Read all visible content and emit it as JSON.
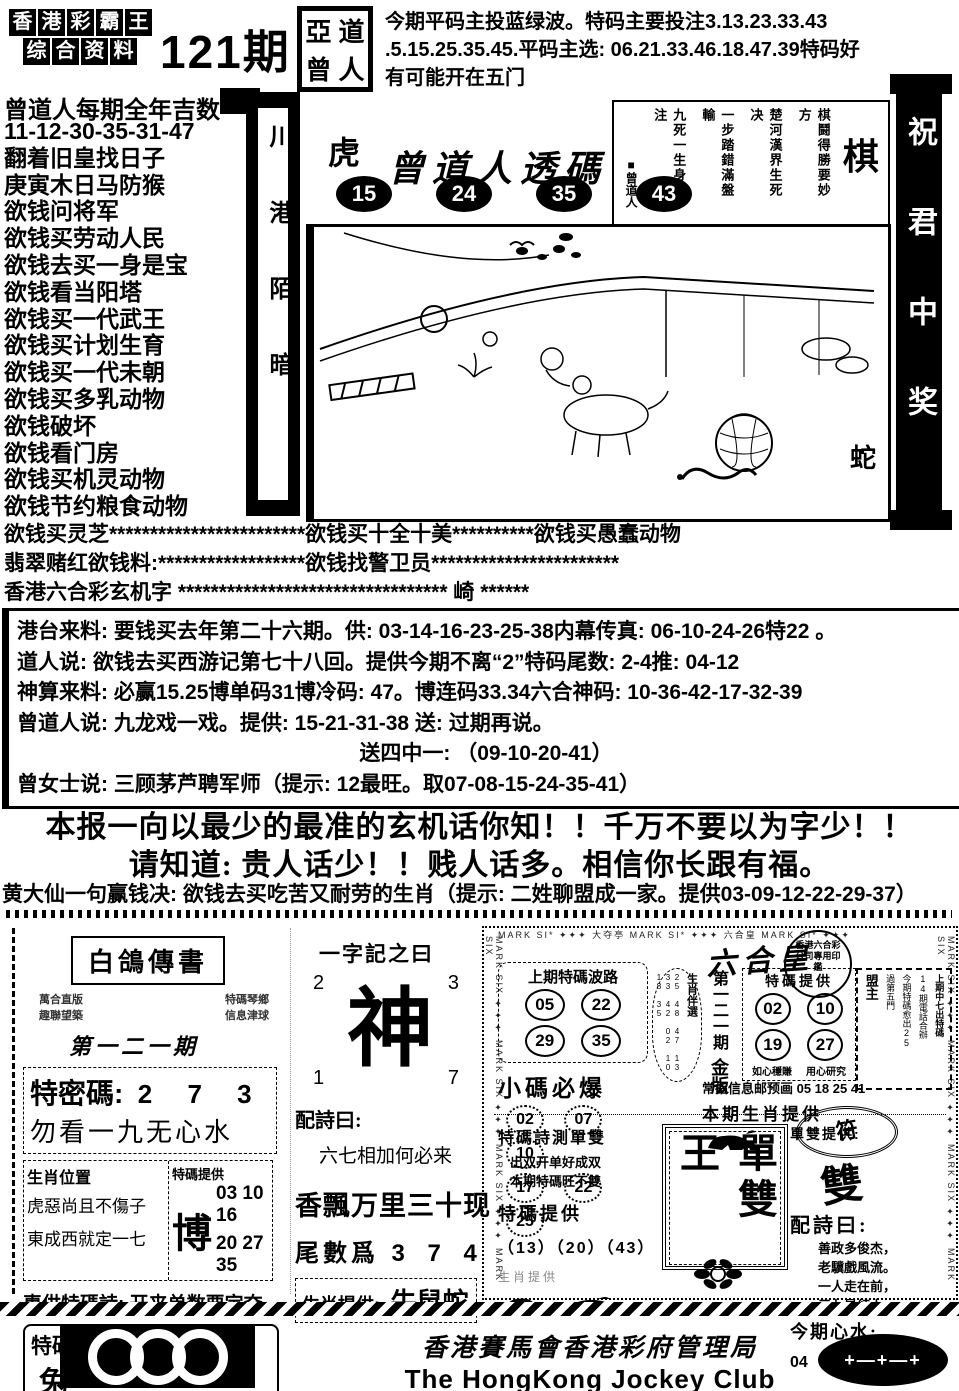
{
  "header": {
    "logo_row1": "香港彩霸王",
    "logo_row2": "综合资料",
    "issue": "121期",
    "seal_chars": "亞道曾人",
    "tips": [
      "今期平码主投蓝绿波。特码主要投注3.13.23.33.43",
      ".5.15.25.35.45.平码主选: 06.21.33.46.18.47.39特码好",
      "有可能开在五门"
    ]
  },
  "left_column": {
    "title": "曾道人每期全年吉数",
    "items": [
      "11-12-30-35-31-47",
      "翻着旧皇找日子",
      "庚寅木日马防猴",
      "欲钱问将军",
      "欲钱买劳动人民",
      "欲钱去买一身是宝",
      "欲钱看当阳塔",
      "欲钱买一代武王",
      "欲钱买计划生育",
      "欲钱买一代未朝",
      "欲钱买多乳动物",
      "欲钱破坏",
      "欲钱看门房",
      "欲钱买机灵动物",
      "欲钱节约粮食动物"
    ]
  },
  "scrolls": {
    "left_chars": "川港陌暗",
    "right_chars": "祝君中奖"
  },
  "center": {
    "zodiac_top": "虎",
    "title": "曾道人透碼",
    "numbers": [
      "15",
      "24",
      "35",
      "43"
    ],
    "zodiac_bottom": "蛇",
    "chess": {
      "big": "棋",
      "title_small": "棋鬪得勝要妙方",
      "cols": [
        "楚河漢界生死决",
        "一步踏錯滿盤輸",
        "九死一生身心注"
      ],
      "author": "■曾道人"
    }
  },
  "star_rows": [
    "欲钱买灵芝************************欲钱买十全十美**********欲钱买愚蠢动物",
    "翡翠赌红欲钱料:******************欲钱找警卫员***********************",
    "香港六合彩玄机字 ********************************* 崎 ******"
  ],
  "info_box": {
    "lines": [
      "港台来料: 要钱买去年第二十六期。供: 03-14-16-23-25-38内幕传真: 06-10-24-26特22 。",
      "道人说: 欲钱去买西游记第七十八回。提供今期不离“2”特码尾数: 2-4推: 04-12",
      "神算来料: 必赢15.25博单码31博冷码: 47。博连码33.34六合神码: 10-36-42-17-32-39",
      "曾道人说: 九龙戏一戏。提供: 15-21-31-38 送: 过期再说。",
      "送四中一: （09-10-20-41）",
      "曾女士说: 三顾茅芦聘军师（提示: 12最旺。取07-08-15-24-35-41）"
    ]
  },
  "slogans": [
    "本报一向以最少的最准的玄机话你知！！千万不要以为字少！！",
    "请知道: 贵人话少！！贱人话多。相信你长跟有福。"
  ],
  "huangdaxian": "黄大仙一句赢钱决: 欲钱去买吃苦又耐劳的生肖（提示: 二姓聊盟成一家。提供03-09-12-22-29-37）",
  "pigeon_panel": {
    "title": "白鴿傳書",
    "small_left1": "萬合直版",
    "small_left2": "趣聯望築",
    "small_right1": "特碼琴鄉",
    "small_right2": "信息津球",
    "issue": "第一二一期",
    "secret_label": "特密碼:",
    "secret_value": "2 7 3",
    "secret_hint": "勿看一九无心水",
    "col1_header": "生肖位置",
    "col1_line1": "虎惡尚且不傷子",
    "col1_line2": "東成西就定一七",
    "col2_header": "特碼提供",
    "col2_big": "博",
    "col2_nums1": "03 10 16",
    "col2_nums2": "20 27 35",
    "poem_label": "專供特碼詩:",
    "poem_text": "开来单数要定夺",
    "sd_label": "特碼單雙提供: 今期開",
    "sd_animal": "兔"
  },
  "word_panel": {
    "title": "一字記之曰",
    "corner_tl": "2",
    "corner_tr": "3",
    "corner_bl": "1",
    "corner_br": "7",
    "big_char": "神",
    "poem_label": "配詩曰:",
    "poem_text": "六七相加何必来",
    "big_line": "香飄万里三十现",
    "tail_label": "尾數爲",
    "tail_value": "3 7 4",
    "zodiac_label": "生肖提供:",
    "zodiac_value": "牛鼠蛇"
  },
  "king_panel": {
    "edge_text": "MARK SIX ✦✦✦ MARK SIX ✦✦✦ MARK SIX ✦✦✦ MARK SIX",
    "top_band": "MARK SI* ✦✦✦ 大夺亭 MARK SI* ✦✦✦ 六合皇 MARK SI* ✦✦✦",
    "brand": "六合皇",
    "brand_seal": "香港六合彩公司專用印鑑",
    "wave_title": "上期特碼波路",
    "wave_numbers": [
      "05",
      "22",
      "29",
      "35"
    ],
    "oval_label": "生肖伴選",
    "oval_nums": "25 48 47 13 33 42 02 10 18 35",
    "issue_vert": "第一二一期",
    "issue_gold": "金版",
    "burst_title": "小碼必爆",
    "burst_numbers": [
      "02",
      "07",
      "10",
      "17",
      "22",
      "25"
    ],
    "tema_title": "特碼提供",
    "tema_numbers": [
      "02",
      "10",
      "19",
      "27"
    ],
    "tema_note1": "如心穩賺",
    "tema_note2": "用心研究",
    "meng_label": "盟主",
    "meng_line1": "上期中七出特碼",
    "meng_line2": "14期電話合辦",
    "meng_line3": "今期特碼愈出25",
    "meng_line4": "過第五門",
    "info_line": "常指信息邮预画 05 18 25 41",
    "zodiac_line": "本期生肖提供",
    "stamp_char": "符",
    "sd_title": "特碼詩測單雙",
    "sd_poem1": "出双开单好成双",
    "sd_poem2": "本期特碼旺不雙",
    "sd_tema_label": "特碼提供",
    "sd_tema_numbers": "（13）（20）（43）",
    "sd_zodiac_label": "生肖提供",
    "center_big": "單雙王",
    "right_label": "單雙提供:",
    "right_glyph": "雙",
    "poem_label": "配詩曰:",
    "poem_lines": [
      "善政多俊杰，",
      "老驥戲風流。",
      "一人走在前，",
      "三七是紅人。"
    ],
    "xinshui_label": "今期心水:",
    "xinshui_numbers": "04（11）（34）（48）"
  },
  "footer": {
    "cn": "香港賽馬會香港彩府管理局",
    "en": "The HongKong Jockey Club",
    "badge": "+—+—+"
  }
}
